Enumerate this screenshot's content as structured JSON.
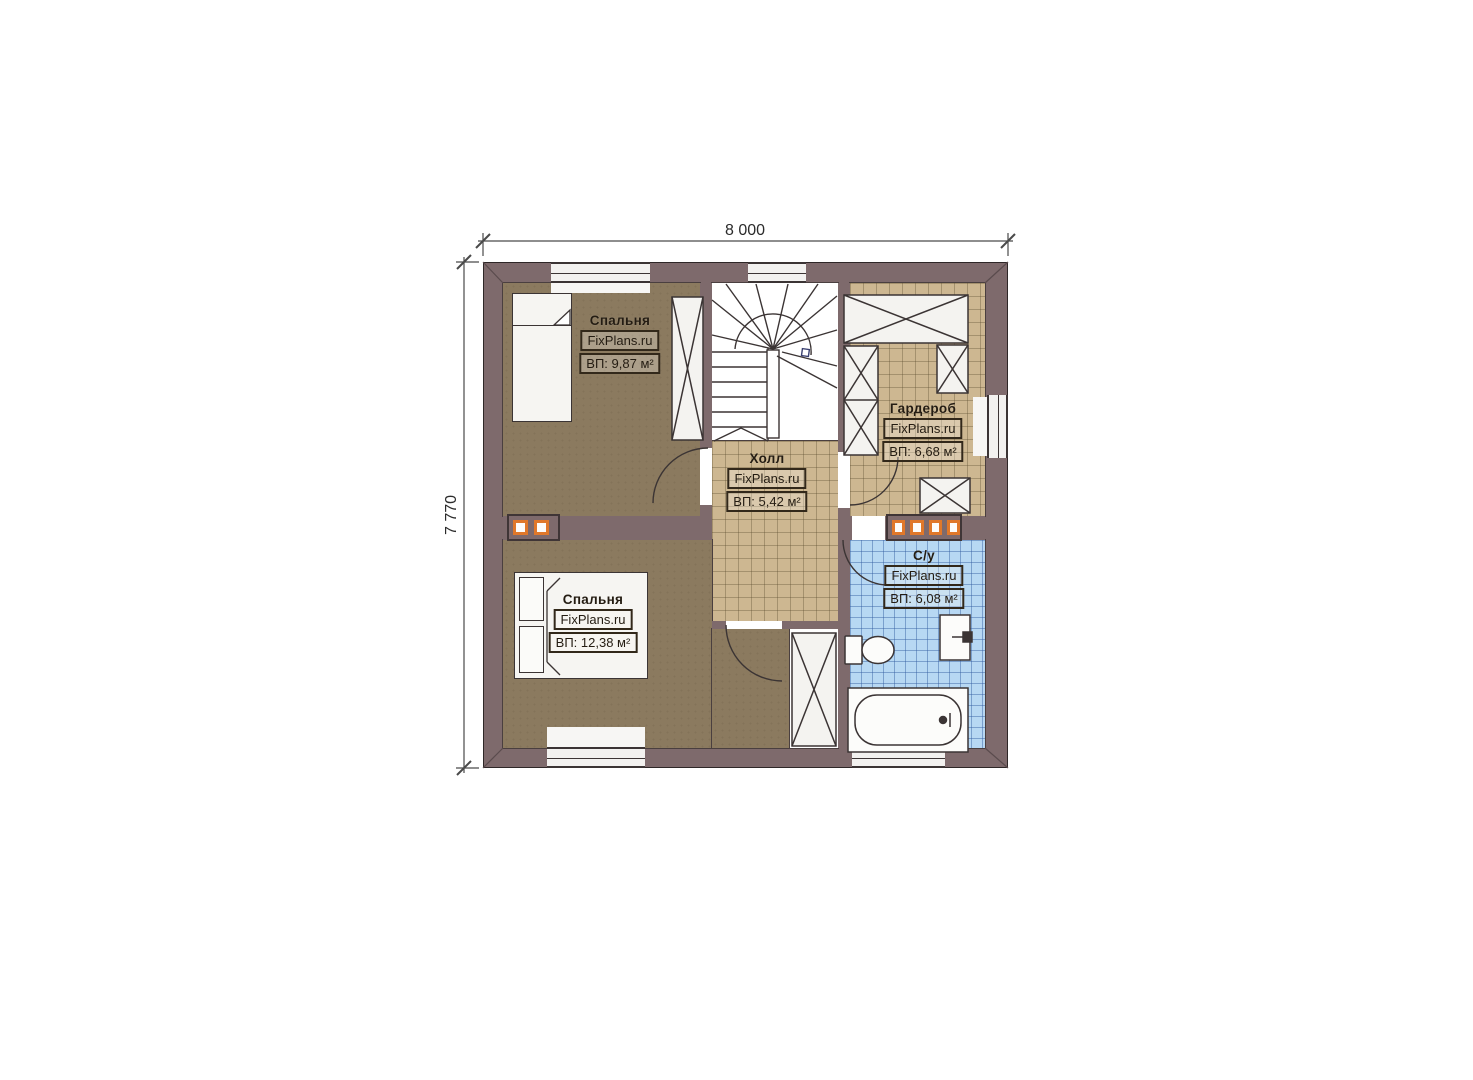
{
  "plan": {
    "title": "Floor plan — second level",
    "dimensions": {
      "width_label": "8 000",
      "height_label": "7 770"
    },
    "watermark": "FixPlans.ru",
    "rooms": [
      {
        "id": "bedroom-1",
        "name": "Спальня",
        "watermark": "FixPlans.ru",
        "area": "ВП: 9,87 м²"
      },
      {
        "id": "wardrobe",
        "name": "Гардероб",
        "watermark": "FixPlans.ru",
        "area": "ВП: 6,68 м²"
      },
      {
        "id": "hall",
        "name": "Холл",
        "watermark": "FixPlans.ru",
        "area": "ВП: 5,42 м²"
      },
      {
        "id": "bedroom-2",
        "name": "Спальня",
        "watermark": "FixPlans.ru",
        "area": "ВП: 12,38 м²"
      },
      {
        "id": "bathroom",
        "name": "С/у",
        "watermark": "FixPlans.ru",
        "area": "ВП: 6,08 м²"
      }
    ],
    "colors": {
      "wall": "#7e6a6c",
      "bedroom_floor": "#8b7a5f",
      "tile_floor": "#cdb791",
      "bathroom_tile": "#b7d8f3",
      "vent_accent": "#e0782a"
    }
  }
}
